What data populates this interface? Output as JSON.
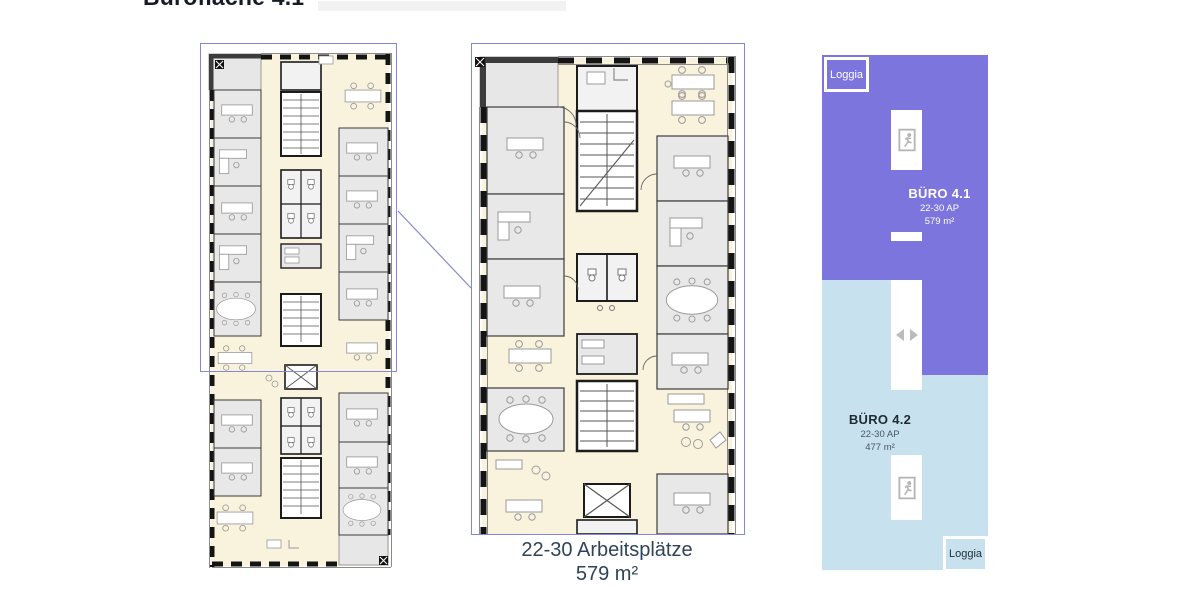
{
  "title": "Bürofläche 4.1",
  "caption": {
    "line1": "22-30 Arbeitsplätze",
    "line2": "579 m²"
  },
  "schematic": {
    "loggia_top": "Loggia",
    "loggia_bottom": "Loggia",
    "units": [
      {
        "name": "BÜRO 4.1",
        "capacity": "22-30 AP",
        "area": "579 m²",
        "color": "#7b75dd",
        "text_color": "#ffffff"
      },
      {
        "name": "BÜRO 4.2",
        "capacity": "22-30 AP",
        "area": "477 m²",
        "color": "#c8e1ef",
        "text_color": "#1f2a33"
      }
    ],
    "icons": {
      "stair_exit": "exit-running-man-icon",
      "elevator": "elevator-left-right-arrows-icon"
    }
  },
  "plan": {
    "frame_color": "#8487d6",
    "corridor_color": "#f9f2dc",
    "room_color": "#e8e8e8",
    "wall_color": "#141414"
  }
}
